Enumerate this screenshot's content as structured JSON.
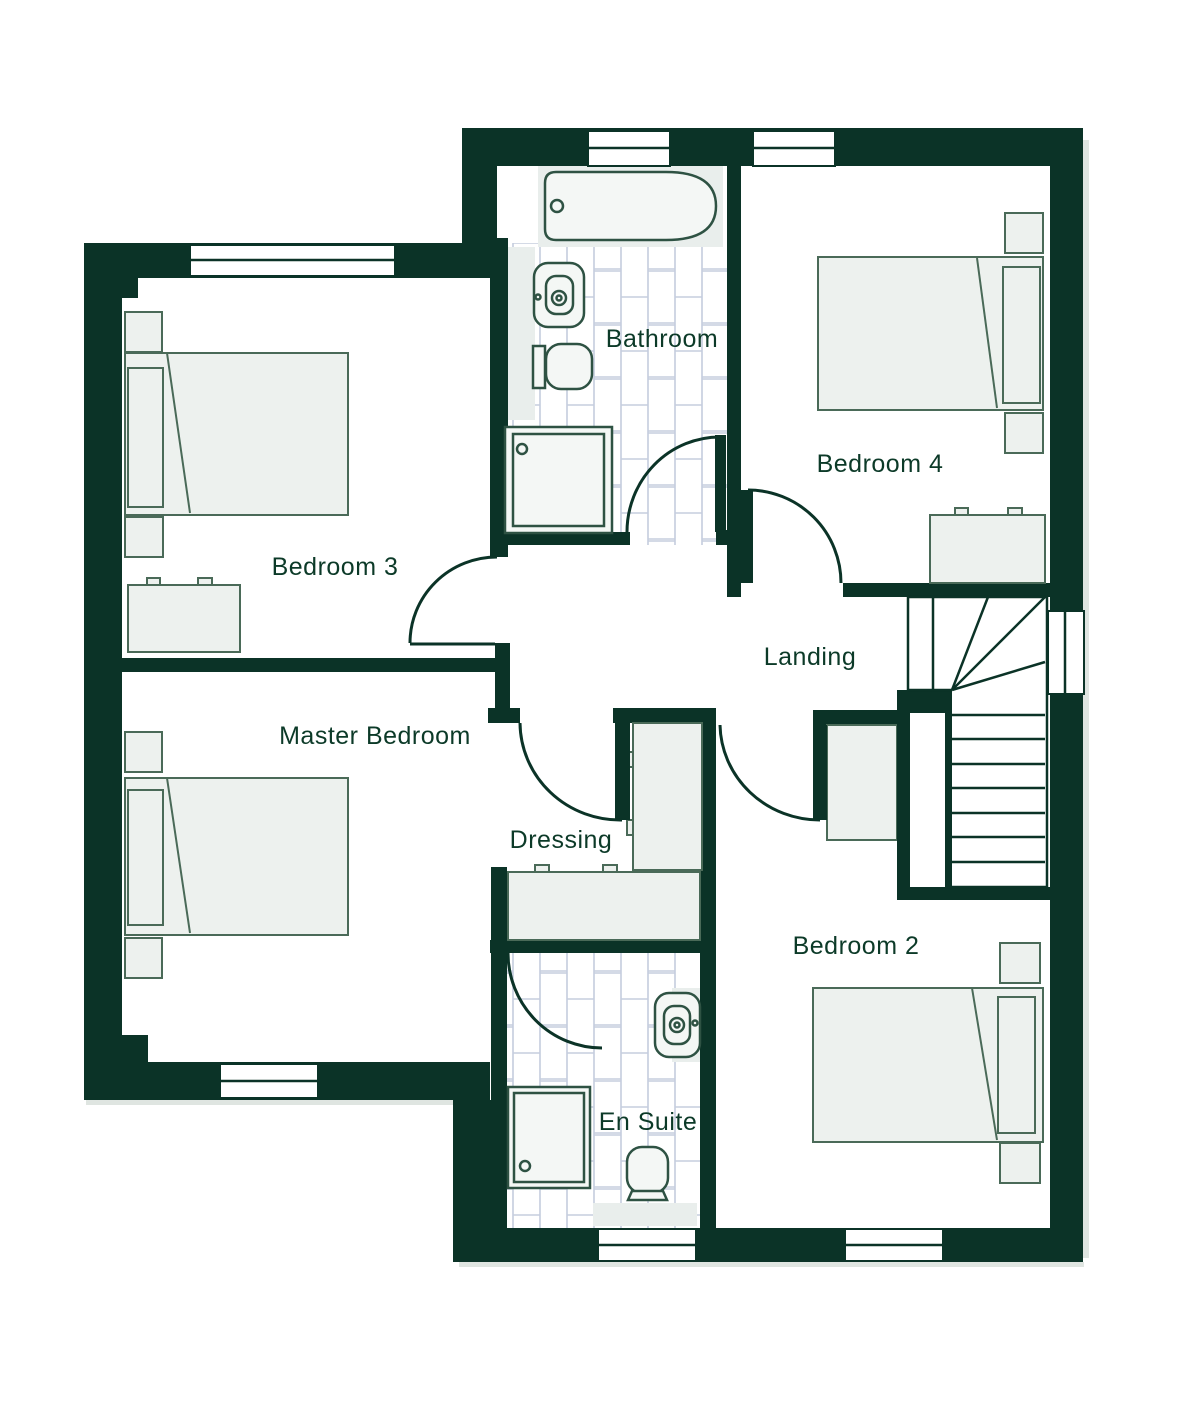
{
  "plan": {
    "type": "floor-plan",
    "rooms": [
      {
        "id": "bathroom",
        "label": "Bathroom"
      },
      {
        "id": "bedroom4",
        "label": "Bedroom 4"
      },
      {
        "id": "bedroom3",
        "label": "Bedroom 3"
      },
      {
        "id": "landing",
        "label": "Landing"
      },
      {
        "id": "master",
        "label": "Master Bedroom"
      },
      {
        "id": "dressing",
        "label": "Dressing"
      },
      {
        "id": "ensuite",
        "label": "En Suite"
      },
      {
        "id": "bedroom2",
        "label": "Bedroom 2"
      }
    ],
    "symbols": [
      "bathtub",
      "washbasin",
      "toilet",
      "shower-tray",
      "double-bed",
      "bedside-table",
      "wardrobe",
      "dresser",
      "staircase",
      "door-swing",
      "window"
    ],
    "colors": {
      "wall": "#0b3327",
      "label_text": "#0c3a28",
      "furniture_fill": "#edf1ee",
      "furniture_stroke": "#4a6a58",
      "tile_line": "#c5cdde",
      "floor": "#ffffff",
      "shadow": "#dfe5e1"
    }
  }
}
